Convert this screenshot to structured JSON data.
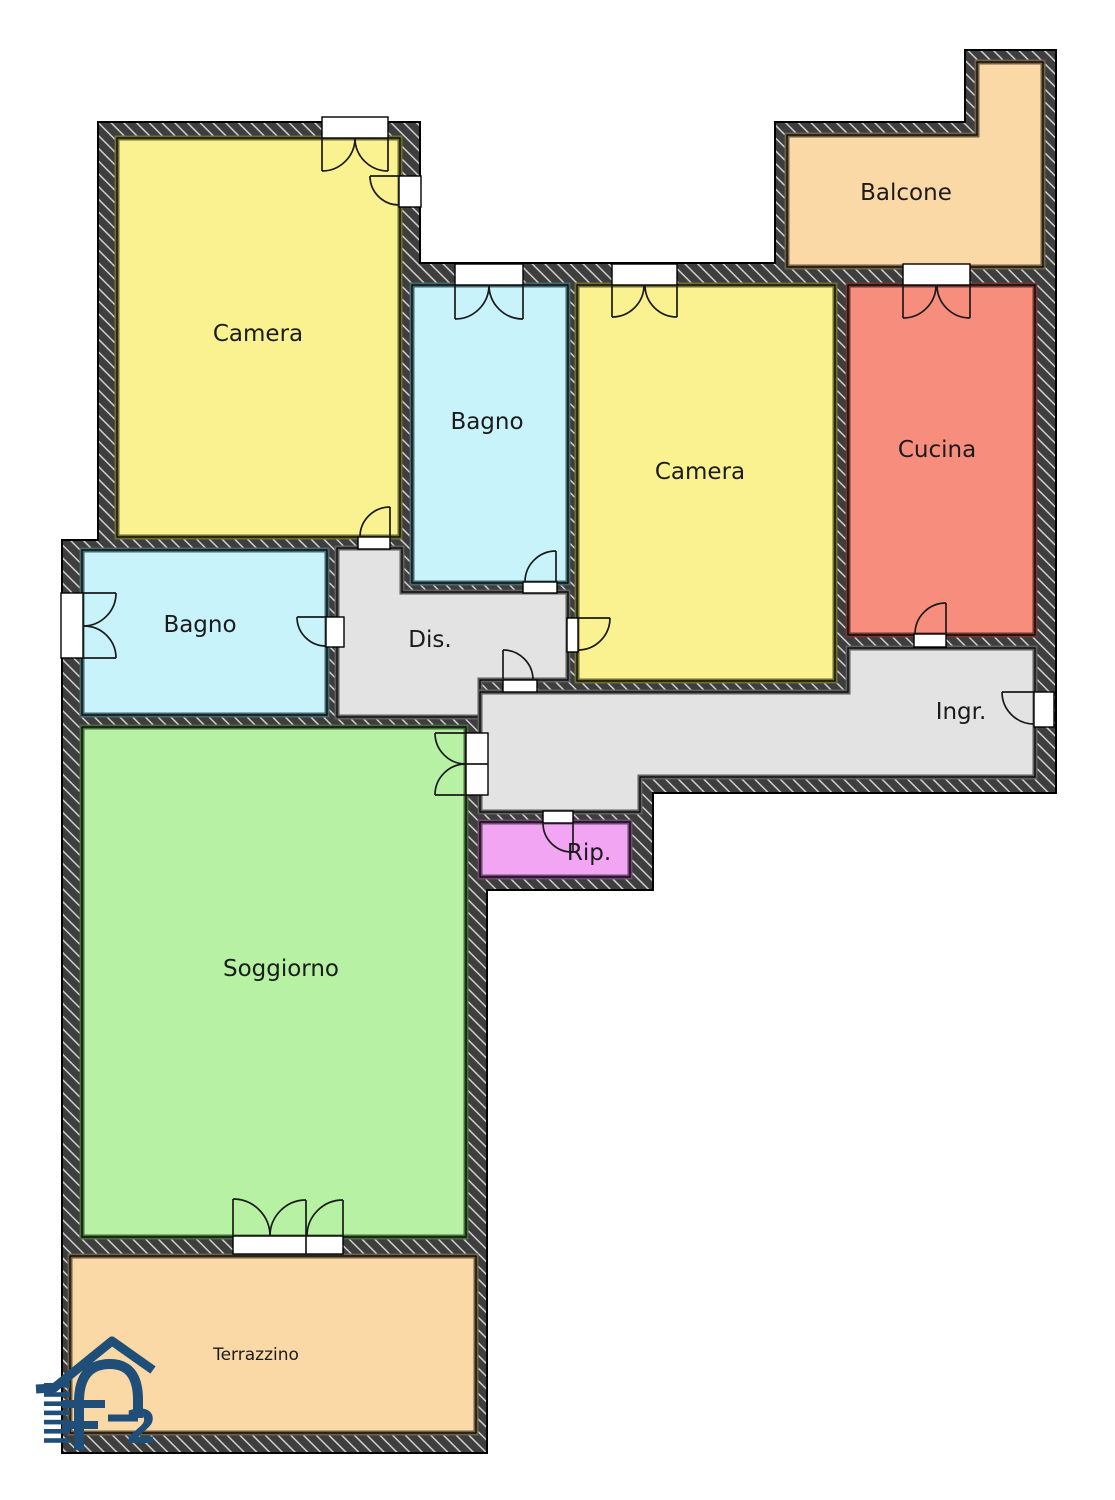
{
  "plan": {
    "rooms": {
      "camera_1": {
        "label": "Camera",
        "fill": "#FAF291",
        "edge": "#6F6D31"
      },
      "bagno_2": {
        "label": "Bagno",
        "fill": "#C8F3FB",
        "edge": "#46686D"
      },
      "camera_2": {
        "label": "Camera",
        "fill": "#FAF291",
        "edge": "#6F6D31"
      },
      "cucina": {
        "label": "Cucina",
        "fill": "#F78D7D",
        "edge": "#713831"
      },
      "balcone": {
        "label": "Balcone",
        "fill": "#FBD9A6",
        "edge": "#6F6046"
      },
      "bagno_1": {
        "label": "Bagno",
        "fill": "#C8F3FB",
        "edge": "#46686D"
      },
      "dis": {
        "label": "Dis.",
        "fill": "#E3E3E3",
        "edge": "#5F5F5F"
      },
      "ingr": {
        "label": "Ingr.",
        "fill": "#E3E3E3",
        "edge": "#5F5F5F"
      },
      "rip": {
        "label": "Rip.",
        "fill": "#F1A5F3",
        "edge": "#6E4870"
      },
      "soggiorno": {
        "label": "Soggiorno",
        "fill": "#B6F1A4",
        "edge": "#4A6B3E"
      },
      "terrazzino": {
        "label": "Terrazzino",
        "fill": "#FBD9A6",
        "edge": "#6F6046"
      }
    },
    "colors": {
      "wall": "#3E3E3E",
      "wall_hatch_line": "#CFCFCF",
      "outline": "#000000",
      "opening_fill": "#FFFFFF",
      "symbol_line": "#1A1A1A",
      "label_text": "#1B1B1B"
    },
    "branding": {
      "logo_text": "FP2",
      "logo_number": "2",
      "logo_color": "#1F4E79"
    }
  }
}
